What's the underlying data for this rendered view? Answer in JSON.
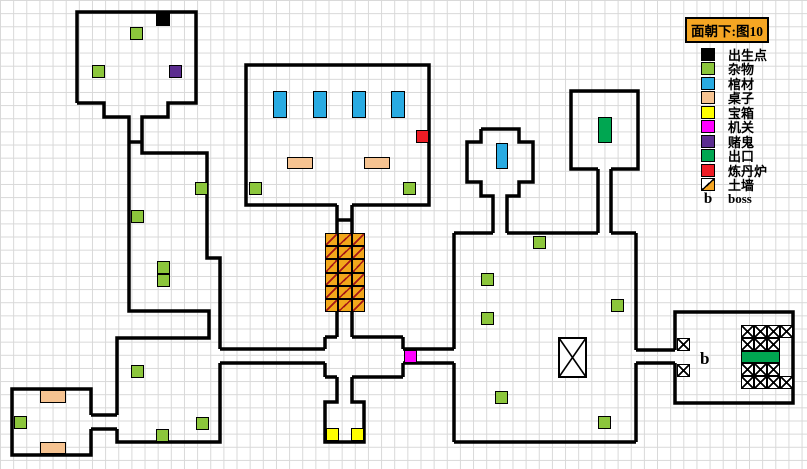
{
  "legend": {
    "title": "面朝下:图10",
    "title_bg": "#f5a623",
    "entries": [
      {
        "key": "spawn",
        "label": "出生点",
        "color": "#000000",
        "style": "solid"
      },
      {
        "key": "sundries",
        "label": "杂物",
        "color": "#8cc63c",
        "style": "solid"
      },
      {
        "key": "coffin",
        "label": "棺材",
        "color": "#29abe2",
        "style": "solid"
      },
      {
        "key": "table",
        "label": "桌子",
        "color": "#f6c391",
        "style": "solid"
      },
      {
        "key": "chest",
        "label": "宝箱",
        "color": "#ffff00",
        "style": "solid"
      },
      {
        "key": "mechanism",
        "label": "机关",
        "color": "#ff00ff",
        "style": "solid"
      },
      {
        "key": "gambler",
        "label": "赌鬼",
        "color": "#5b2c8f",
        "style": "solid"
      },
      {
        "key": "exit",
        "label": "出口",
        "color": "#00a651",
        "style": "solid"
      },
      {
        "key": "furnace",
        "label": "炼丹炉",
        "color": "#ee1c25",
        "style": "solid"
      },
      {
        "key": "earthwall",
        "label": "土墙",
        "color": "#f5a623",
        "style": "diagonal"
      },
      {
        "key": "boss",
        "label": "boss",
        "symbol": "b",
        "style": "text"
      }
    ]
  },
  "map": {
    "boss_label": "b",
    "objects": [
      {
        "type": "spawn",
        "x": 156,
        "y": 13,
        "w": 14,
        "h": 13
      },
      {
        "type": "sundries",
        "x": 130,
        "y": 27,
        "w": 13,
        "h": 13
      },
      {
        "type": "sundries",
        "x": 92,
        "y": 65,
        "w": 13,
        "h": 13
      },
      {
        "type": "gambler",
        "x": 169,
        "y": 65,
        "w": 13,
        "h": 13
      },
      {
        "type": "coffin",
        "x": 273,
        "y": 91,
        "w": 14,
        "h": 27
      },
      {
        "type": "coffin",
        "x": 313,
        "y": 91,
        "w": 14,
        "h": 27
      },
      {
        "type": "coffin",
        "x": 352,
        "y": 91,
        "w": 14,
        "h": 27
      },
      {
        "type": "coffin",
        "x": 391,
        "y": 91,
        "w": 14,
        "h": 27
      },
      {
        "type": "furnace",
        "x": 416,
        "y": 130,
        "w": 13,
        "h": 13
      },
      {
        "type": "table",
        "x": 287,
        "y": 157,
        "w": 26,
        "h": 12
      },
      {
        "type": "table",
        "x": 364,
        "y": 157,
        "w": 26,
        "h": 12
      },
      {
        "type": "sundries",
        "x": 249,
        "y": 182,
        "w": 13,
        "h": 13
      },
      {
        "type": "sundries",
        "x": 403,
        "y": 182,
        "w": 13,
        "h": 13
      },
      {
        "type": "sundries",
        "x": 195,
        "y": 182,
        "w": 13,
        "h": 13
      },
      {
        "type": "sundries",
        "x": 131,
        "y": 210,
        "w": 13,
        "h": 13
      },
      {
        "type": "sundries",
        "x": 157,
        "y": 261,
        "w": 13,
        "h": 13
      },
      {
        "type": "sundries",
        "x": 157,
        "y": 274,
        "w": 13,
        "h": 13
      },
      {
        "type": "coffin",
        "x": 496,
        "y": 143,
        "w": 12,
        "h": 26
      },
      {
        "type": "exit",
        "x": 598,
        "y": 117,
        "w": 14,
        "h": 26
      },
      {
        "type": "sundries",
        "x": 533,
        "y": 236,
        "w": 13,
        "h": 13
      },
      {
        "type": "sundries",
        "x": 481,
        "y": 273,
        "w": 13,
        "h": 13
      },
      {
        "type": "sundries",
        "x": 481,
        "y": 312,
        "w": 13,
        "h": 13
      },
      {
        "type": "sundries",
        "x": 611,
        "y": 299,
        "w": 13,
        "h": 13
      },
      {
        "type": "sundries",
        "x": 495,
        "y": 391,
        "w": 13,
        "h": 13
      },
      {
        "type": "sundries",
        "x": 598,
        "y": 416,
        "w": 13,
        "h": 13
      },
      {
        "type": "mechanism",
        "x": 404,
        "y": 350,
        "w": 13,
        "h": 13
      },
      {
        "type": "sundries",
        "x": 131,
        "y": 365,
        "w": 13,
        "h": 13
      },
      {
        "type": "sundries",
        "x": 196,
        "y": 417,
        "w": 13,
        "h": 13
      },
      {
        "type": "sundries",
        "x": 156,
        "y": 429,
        "w": 13,
        "h": 13
      },
      {
        "type": "table",
        "x": 40,
        "y": 390,
        "w": 26,
        "h": 13
      },
      {
        "type": "table",
        "x": 40,
        "y": 442,
        "w": 26,
        "h": 12
      },
      {
        "type": "sundries",
        "x": 14,
        "y": 416,
        "w": 13,
        "h": 13
      },
      {
        "type": "chest",
        "x": 326,
        "y": 428,
        "w": 13,
        "h": 13
      },
      {
        "type": "chest",
        "x": 351,
        "y": 428,
        "w": 13,
        "h": 13
      },
      {
        "type": "exit",
        "x": 741,
        "y": 351,
        "w": 39,
        "h": 12
      }
    ],
    "earth_wall": {
      "x": 325,
      "y": 233,
      "cols": 3,
      "rows": 6,
      "cell_w": 13.3,
      "cell_h": 13.2
    },
    "hatch_cells": [
      {
        "x": 677,
        "y": 338,
        "w": 13,
        "h": 13
      },
      {
        "x": 677,
        "y": 364,
        "w": 13,
        "h": 13
      },
      {
        "x": 741,
        "y": 325,
        "w": 13,
        "h": 13
      },
      {
        "x": 754,
        "y": 325,
        "w": 13,
        "h": 13
      },
      {
        "x": 767,
        "y": 325,
        "w": 13,
        "h": 13
      },
      {
        "x": 780,
        "y": 325,
        "w": 13,
        "h": 13
      },
      {
        "x": 741,
        "y": 338,
        "w": 13,
        "h": 13
      },
      {
        "x": 754,
        "y": 338,
        "w": 13,
        "h": 13
      },
      {
        "x": 767,
        "y": 338,
        "w": 13,
        "h": 13
      },
      {
        "x": 741,
        "y": 363,
        "w": 13,
        "h": 13
      },
      {
        "x": 754,
        "y": 363,
        "w": 13,
        "h": 13
      },
      {
        "x": 767,
        "y": 363,
        "w": 13,
        "h": 13
      },
      {
        "x": 741,
        "y": 376,
        "w": 13,
        "h": 13
      },
      {
        "x": 754,
        "y": 376,
        "w": 13,
        "h": 13
      },
      {
        "x": 767,
        "y": 376,
        "w": 13,
        "h": 13
      },
      {
        "x": 780,
        "y": 376,
        "w": 13,
        "h": 13
      }
    ]
  }
}
